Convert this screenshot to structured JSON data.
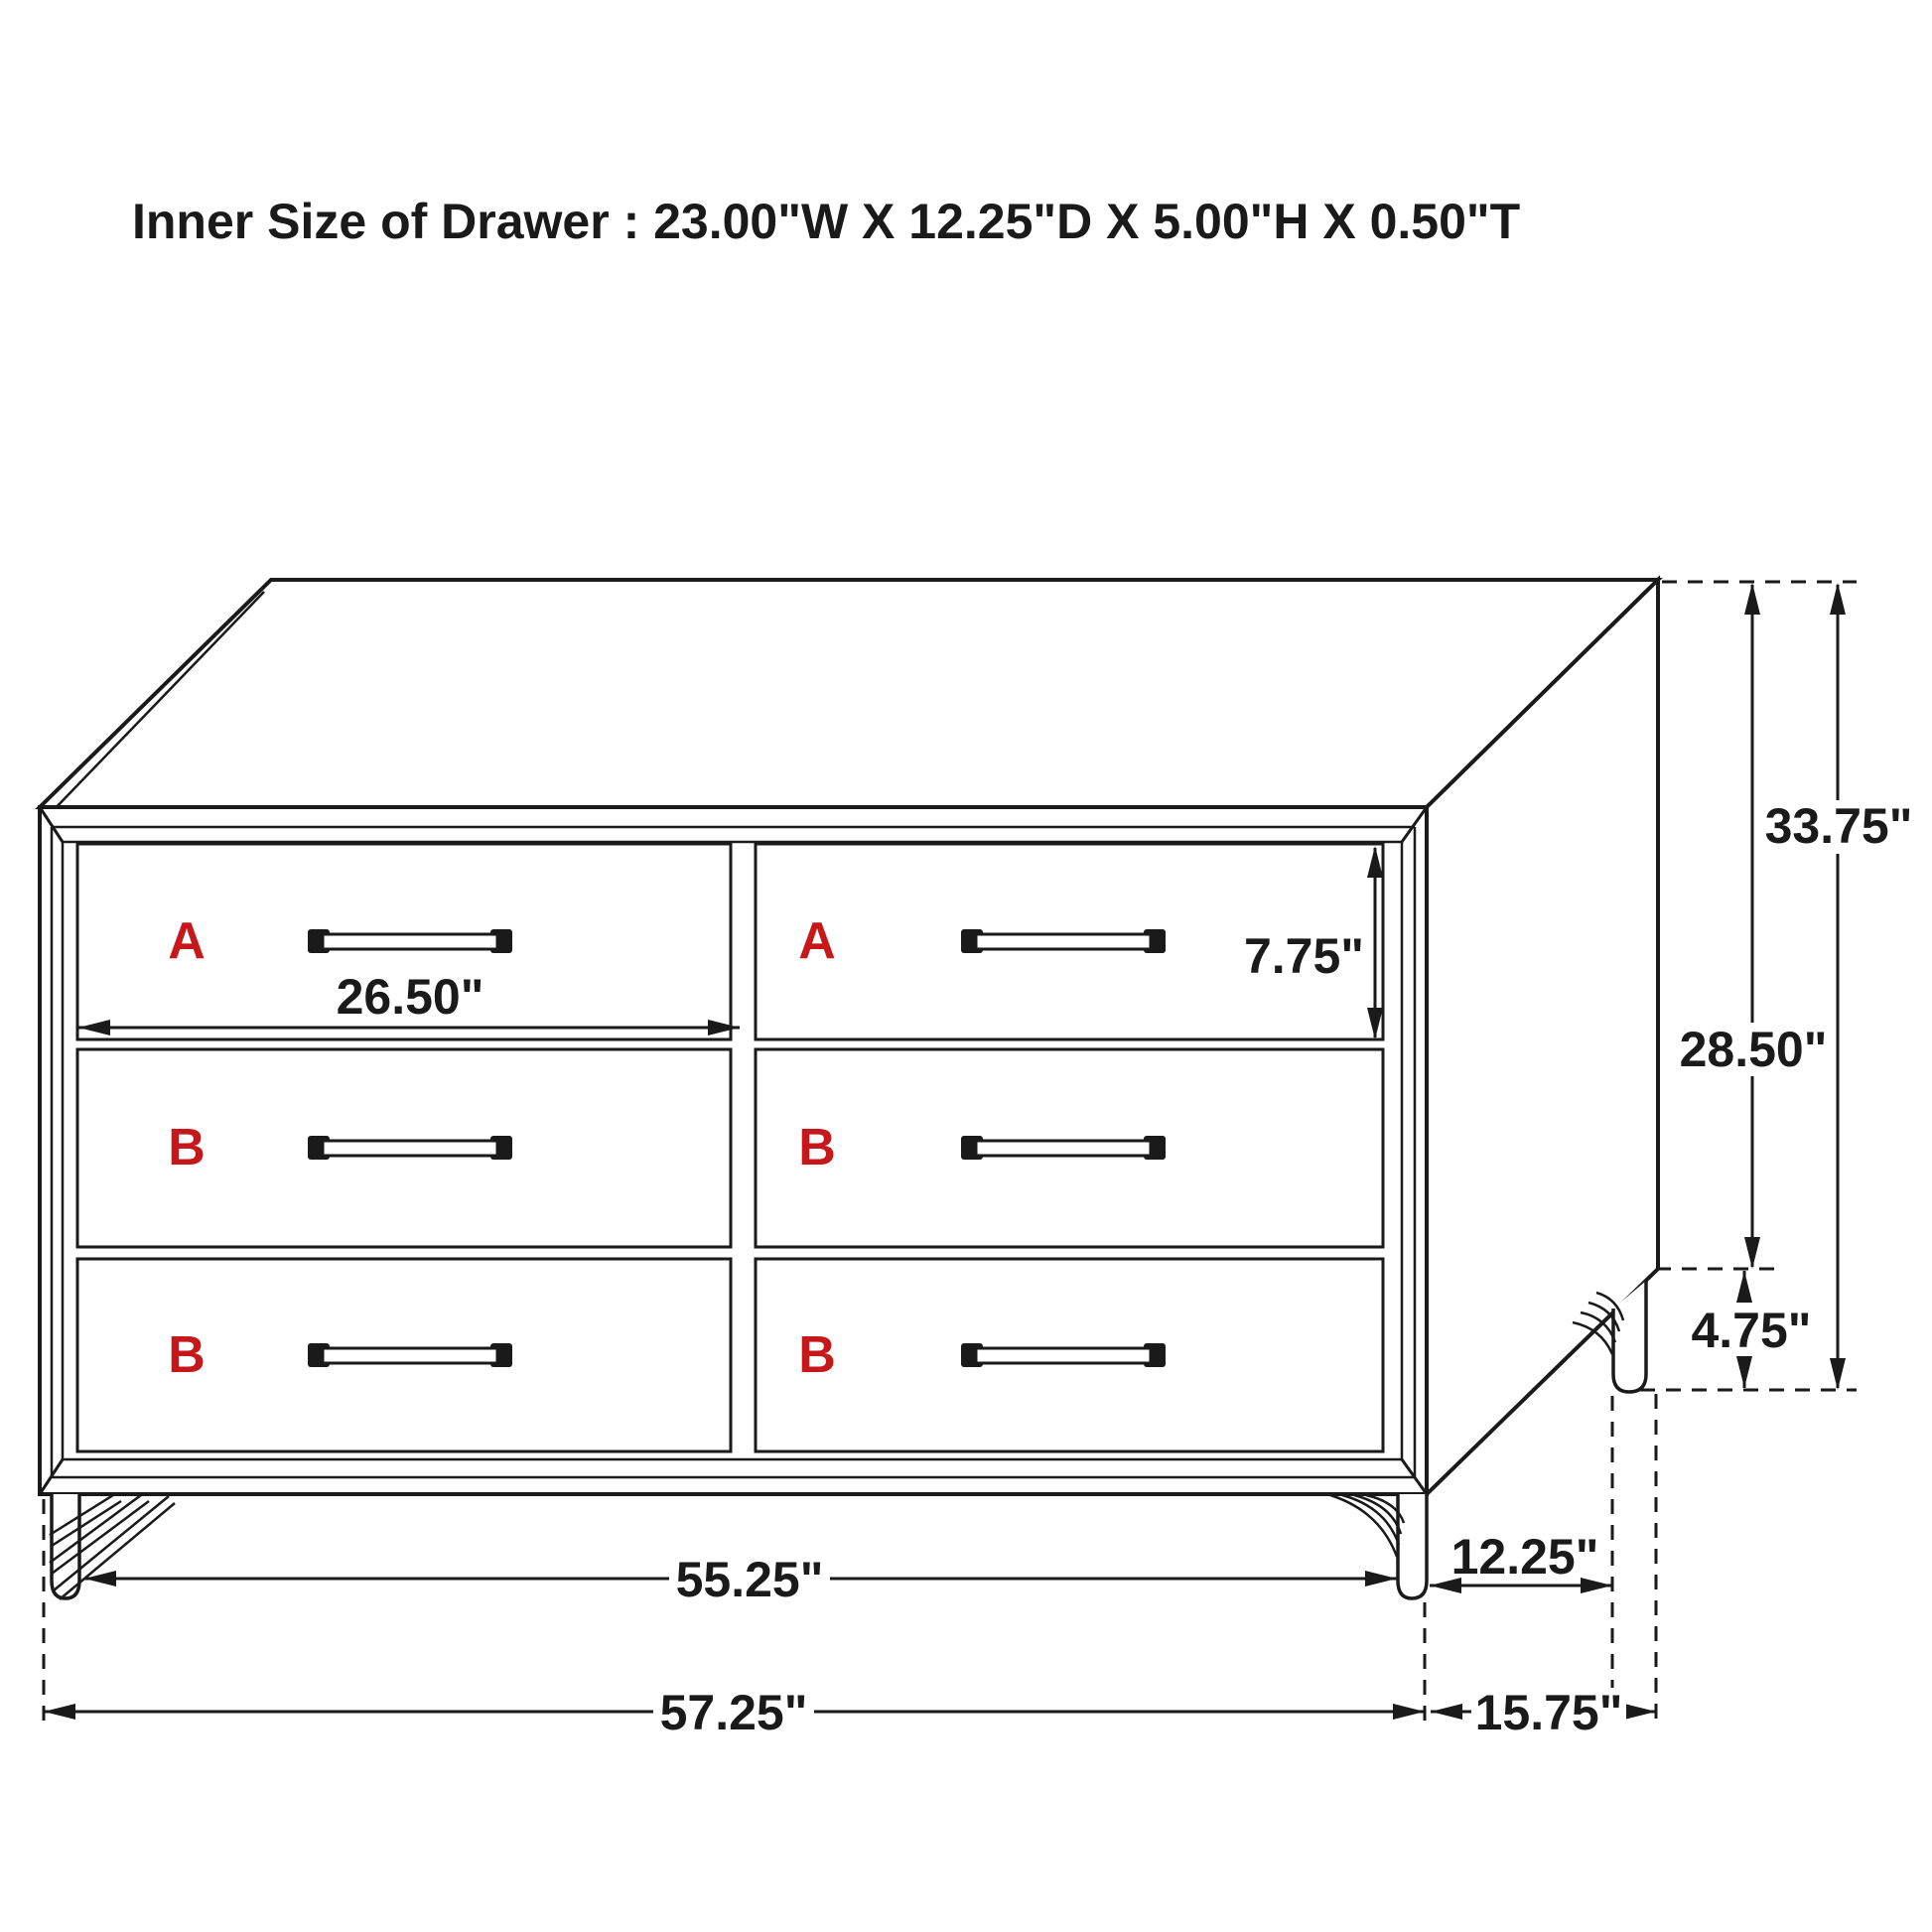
{
  "title": "Inner Size of Drawer : 23.00\"W X 12.25\"D X 5.00\"H X 0.50\"T",
  "drawer_labels": {
    "top_left": "A",
    "top_right": "A",
    "mid_left": "B",
    "mid_right": "B",
    "bot_left": "B",
    "bot_right": "B"
  },
  "dimensions": {
    "drawer_inner_width": "26.50\"",
    "drawer_front_height": "7.75\"",
    "overall_height": "33.75\"",
    "cabinet_body_height": "28.50\"",
    "leg_height": "4.75\"",
    "front_leg_span": "55.25\"",
    "side_leg_span": "12.25\"",
    "overall_width": "57.25\"",
    "overall_depth": "15.75\""
  },
  "colors": {
    "outline": "#1a1a1a",
    "label_red": "#c6171b",
    "background": "#ffffff"
  }
}
